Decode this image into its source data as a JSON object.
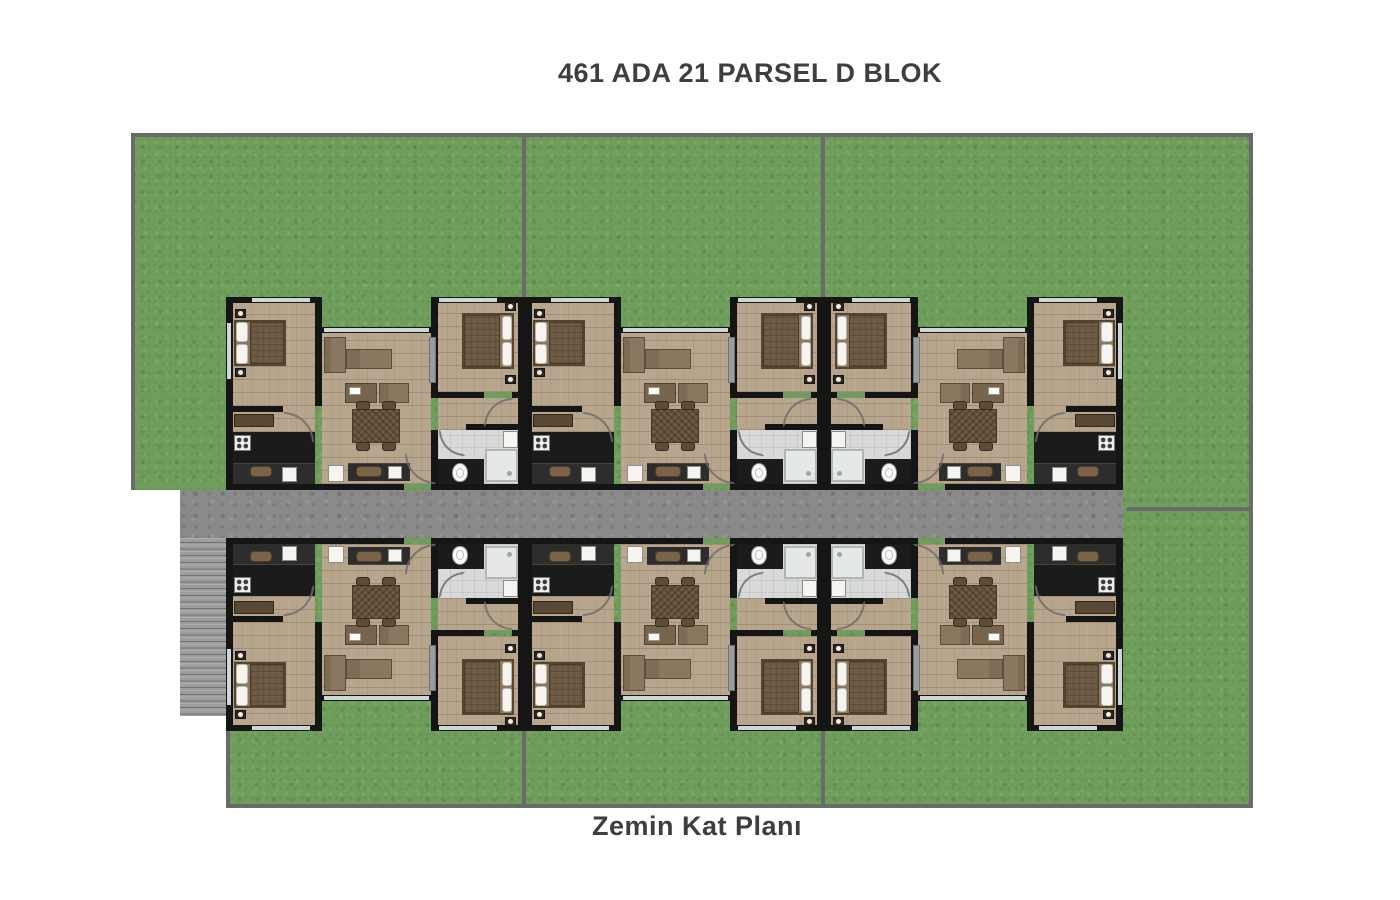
{
  "plan": {
    "title": "461 ADA 21 PARSEL D BLOK",
    "floor_label": "Zemin Kat Planı"
  },
  "building": {
    "rows": 2,
    "units_per_row": 3,
    "total_units": 6,
    "rooms_per_unit": [
      "bedroom",
      "bedroom",
      "living-room",
      "kitchen",
      "bathroom",
      "hall"
    ],
    "units": [
      {
        "row": "top",
        "column": 1,
        "mirrored_x": false
      },
      {
        "row": "top",
        "column": 2,
        "mirrored_x": false
      },
      {
        "row": "top",
        "column": 3,
        "mirrored_x": true
      },
      {
        "row": "bottom",
        "column": 1,
        "mirrored_x": false
      },
      {
        "row": "bottom",
        "column": 2,
        "mirrored_x": false
      },
      {
        "row": "bottom",
        "column": 3,
        "mirrored_x": true
      }
    ]
  },
  "site": {
    "garden_parcels": 8,
    "features": [
      "garden",
      "corridor",
      "staircase",
      "parcel-dividers"
    ]
  },
  "colors": {
    "background": "#ffffff",
    "grass": "#6f9d5b",
    "plot_border": "#6a6a6a",
    "corridor_concrete": "#8a8a8a",
    "stairs": "#9d9d9d",
    "wall": "#151515",
    "wood_floor": "#b8a58d",
    "kitchen_dark": "#1b1b1b",
    "bathroom_tile": "#d8dada",
    "furniture_brown": "#8b7760",
    "bed_duvet": "#6e5b45",
    "fixture_white": "#f5f4f1",
    "window": "#cfd6d6",
    "title_text": "#3e3e3e"
  }
}
